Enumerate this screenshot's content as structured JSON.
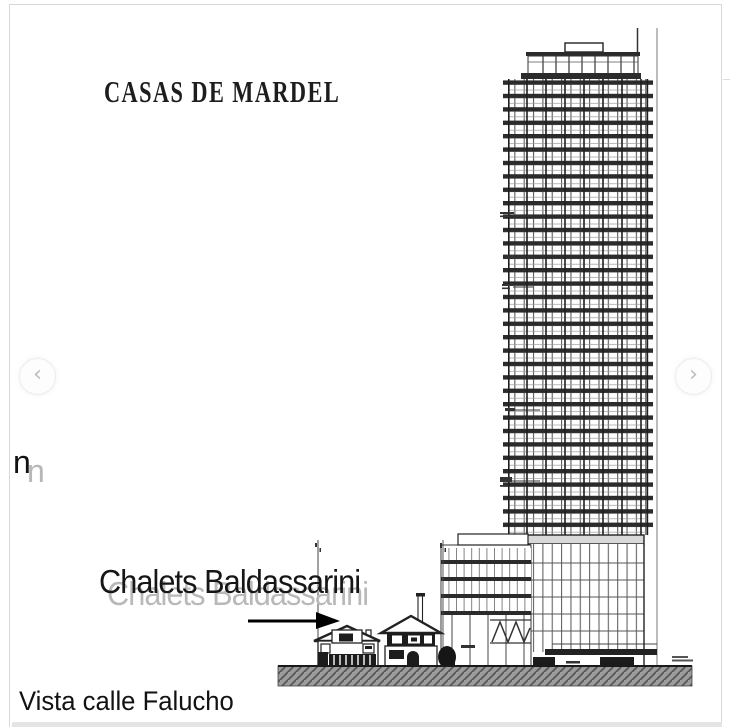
{
  "header": {
    "title": "CASAS DE MARDEL"
  },
  "carousel": {
    "prev_icon": "‹",
    "next_icon": "›"
  },
  "labels": {
    "chalets_annotation": "Chalets Baldassarini",
    "chalets_annotation_ghost": "Chalets Baldassarini",
    "edge_fragment": "n",
    "edge_fragment_ghost": "n",
    "caption": "Vista calle Falucho"
  },
  "drawing": {
    "description": "architectural street elevation: high-rise tower with podium beside two small chalets, hatched ground line, lot-line markers and arrow pointing at chalets",
    "colors": {
      "ink": "#222222",
      "slab": "#2b2b2b",
      "ghost_text": "#b9b9b9",
      "ground_hatch": "#9c9c9c",
      "frame_border": "#d8d8d8",
      "nav_chevron": "#bcbcbc"
    }
  }
}
